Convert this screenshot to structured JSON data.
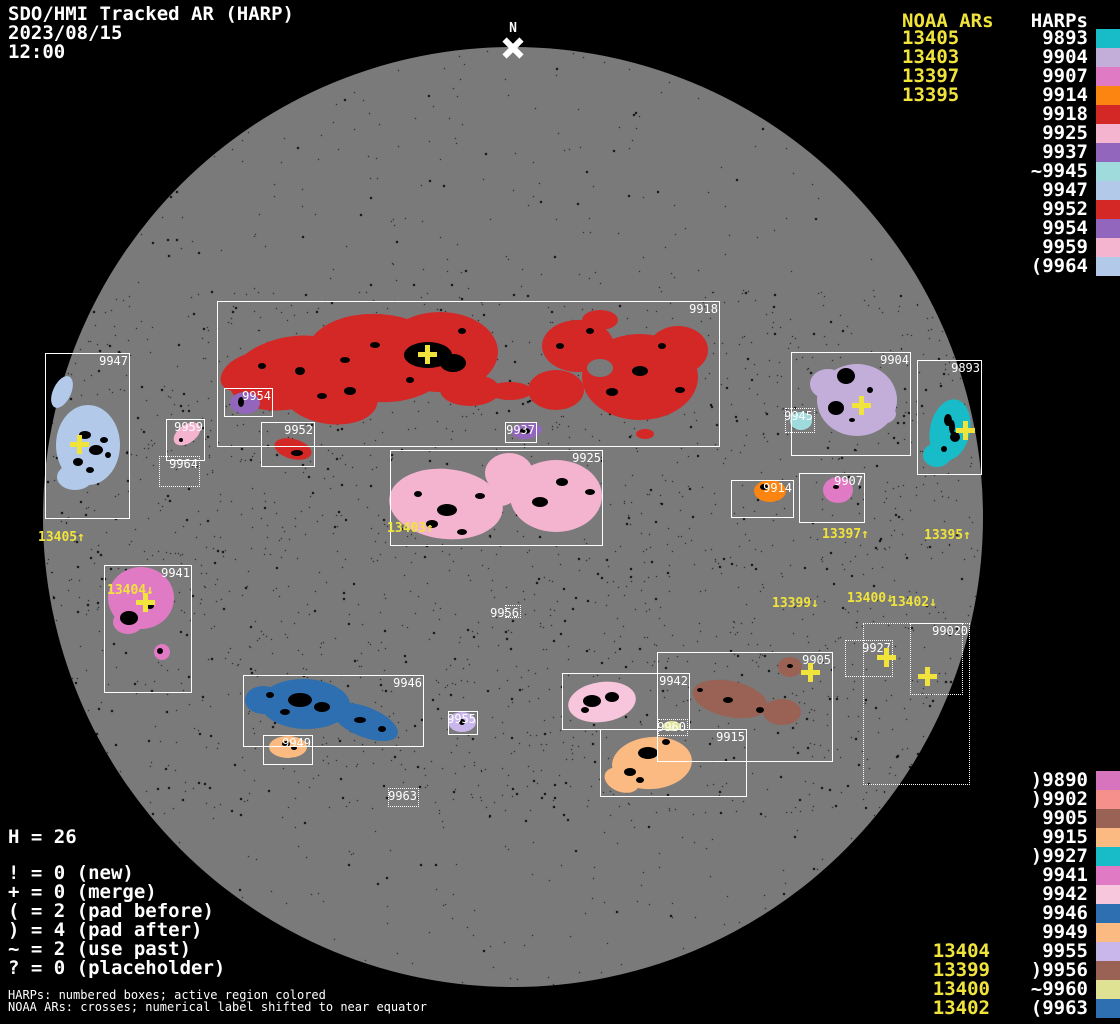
{
  "header": {
    "title": "SDO/HMI Tracked AR (HARP)",
    "date": "2023/08/15",
    "time": "12:00"
  },
  "north_marker": "N",
  "colors": {
    "background": "#000000",
    "disk": "#7a7a7a",
    "box_outline": "#ffffff",
    "noaa_yellow": "#f0e43c",
    "sunspot": "#000000"
  },
  "legend_top": {
    "noaa_header": "NOAA ARs",
    "harps_header": "HARPs",
    "rows": [
      {
        "noaa": "13405",
        "harp": "9893",
        "color": "#18bcc8"
      },
      {
        "noaa": "13403",
        "harp": "9904",
        "color": "#c2aed8"
      },
      {
        "noaa": "13397",
        "harp": "9907",
        "color": "#e07ac4"
      },
      {
        "noaa": "13395",
        "harp": "9914",
        "color": "#fb8510"
      },
      {
        "harp": "9918",
        "color": "#d42827"
      },
      {
        "harp": "9925",
        "color": "#f4b3cf"
      },
      {
        "harp": "9937",
        "color": "#9266bd"
      },
      {
        "harp": "~9945",
        "color": "#9fdbdd"
      },
      {
        "harp": "9947",
        "color": "#b3c9ea"
      },
      {
        "harp": "9952",
        "color": "#d42827"
      },
      {
        "harp": "9954",
        "color": "#9266bd"
      },
      {
        "harp": "9959",
        "color": "#f4b3cf"
      },
      {
        "harp": "(9964",
        "color": "#b3c9ea"
      }
    ]
  },
  "legend_bottom": {
    "rows": [
      {
        "harp": ")9890",
        "color": "#d873bd"
      },
      {
        "harp": ")9902",
        "color": "#f5908d"
      },
      {
        "harp": "9905",
        "color": "#996255"
      },
      {
        "harp": "9915",
        "color": "#fbba81"
      },
      {
        "harp": ")9927",
        "color": "#18bcc8"
      },
      {
        "harp": "9941",
        "color": "#e07ac4"
      },
      {
        "harp": "9942",
        "color": "#f7c5dc"
      },
      {
        "harp": "9946",
        "color": "#2d6fb0"
      },
      {
        "harp": "9949",
        "color": "#fbba81"
      },
      {
        "noaa": "13404",
        "harp": "9955",
        "color": "#c9b6ea"
      },
      {
        "noaa": "13399",
        "harp": ")9956",
        "color": "#996255"
      },
      {
        "noaa": "13400",
        "harp": "~9960",
        "color": "#dfe293"
      },
      {
        "noaa": "13402",
        "harp": "(9963",
        "color": "#2d6fb0"
      }
    ]
  },
  "stats": {
    "total": "H = 26",
    "lines": [
      "! = 0 (new)",
      "+ = 0 (merge)",
      "( = 2 (pad before)",
      ") = 4 (pad after)",
      "~ = 2 (use past)",
      "? = 0 (placeholder)"
    ]
  },
  "footer": {
    "line1": "HARPs: numbered boxes; active region colored",
    "line2": "NOAA ARs: crosses; numerical label shifted to near equator"
  },
  "regions": [
    {
      "id": "9918",
      "label": "9918",
      "box": [
        217,
        301,
        503,
        146
      ],
      "style": "solid",
      "color": "#d42827",
      "blobs": [
        [
          290,
          373,
          62,
          36,
          -12
        ],
        [
          378,
          358,
          72,
          44,
          4
        ],
        [
          440,
          352,
          58,
          40,
          0
        ],
        [
          330,
          396,
          48,
          28,
          8
        ],
        [
          247,
          372,
          28,
          17,
          -25
        ],
        [
          470,
          390,
          30,
          16,
          0
        ],
        [
          510,
          391,
          22,
          9,
          0
        ],
        [
          578,
          346,
          36,
          26,
          0
        ],
        [
          640,
          377,
          58,
          43,
          0
        ],
        [
          678,
          350,
          30,
          24,
          0
        ],
        [
          556,
          390,
          28,
          20,
          0
        ],
        [
          600,
          320,
          18,
          10,
          0
        ],
        [
          645,
          434,
          9,
          5,
          0
        ]
      ],
      "holes": [
        [
          600,
          368,
          13,
          9
        ]
      ],
      "spots": [
        [
          428,
          355,
          24,
          13
        ],
        [
          453,
          363,
          13,
          9
        ],
        [
          350,
          391,
          6,
          4
        ],
        [
          300,
          371,
          5,
          4
        ],
        [
          322,
          396,
          5,
          3
        ],
        [
          560,
          346,
          4,
          3
        ],
        [
          612,
          392,
          6,
          4
        ],
        [
          640,
          371,
          8,
          5
        ],
        [
          662,
          346,
          4,
          3
        ],
        [
          590,
          331,
          4,
          3
        ],
        [
          462,
          331,
          4,
          3
        ],
        [
          262,
          366,
          4,
          3
        ],
        [
          375,
          345,
          5,
          3
        ],
        [
          410,
          380,
          4,
          3
        ],
        [
          680,
          390,
          5,
          3
        ],
        [
          345,
          360,
          5,
          3
        ]
      ]
    },
    {
      "id": "9947",
      "label": "9947",
      "box": [
        45,
        353,
        85,
        166
      ],
      "style": "solid",
      "color": "#b3c9ea",
      "blobs": [
        [
          88,
          445,
          32,
          40,
          0
        ],
        [
          75,
          477,
          18,
          13,
          0
        ],
        [
          62,
          392,
          9,
          17,
          25
        ]
      ],
      "spots": [
        [
          85,
          435,
          6,
          4
        ],
        [
          96,
          450,
          7,
          5
        ],
        [
          78,
          462,
          5,
          4
        ],
        [
          104,
          440,
          4,
          3
        ],
        [
          90,
          470,
          4,
          3
        ],
        [
          108,
          455,
          3,
          3
        ]
      ]
    },
    {
      "id": "9959",
      "label": "9959",
      "box": [
        166,
        419,
        39,
        42
      ],
      "style": "solid",
      "color": "#f4b3cf",
      "blobs": [
        [
          187,
          434,
          15,
          9,
          -35
        ]
      ],
      "spots": [
        [
          181,
          440,
          2,
          2
        ]
      ]
    },
    {
      "id": "9964",
      "label": "9964",
      "box": [
        159,
        456,
        41,
        31
      ],
      "style": "dotted",
      "blobs": [],
      "spots": []
    },
    {
      "id": "9954",
      "label": "9954",
      "box": [
        224,
        388,
        49,
        29
      ],
      "style": "solid",
      "color": "#9266bd",
      "blobs": [
        [
          245,
          403,
          15,
          11,
          0
        ]
      ],
      "spots": [
        [
          241,
          402,
          3,
          5
        ]
      ]
    },
    {
      "id": "9952",
      "label": "9952",
      "box": [
        261,
        422,
        54,
        45
      ],
      "style": "solid",
      "color": "#d42827",
      "blobs": [
        [
          293,
          449,
          19,
          10,
          15
        ]
      ],
      "spots": [
        [
          297,
          453,
          6,
          3
        ]
      ]
    },
    {
      "id": "9937",
      "label": "9937",
      "box": [
        505,
        422,
        32,
        21
      ],
      "style": "solid",
      "color": "#9266bd",
      "blobs": [
        [
          527,
          431,
          15,
          8,
          -8
        ]
      ],
      "spots": [
        [
          525,
          431,
          5,
          3
        ]
      ]
    },
    {
      "id": "9925",
      "label": "9925",
      "box": [
        390,
        450,
        213,
        96
      ],
      "style": "solid",
      "color": "#f4b3cf",
      "blobs": [
        [
          446,
          504,
          57,
          35,
          6
        ],
        [
          509,
          473,
          24,
          20,
          0
        ],
        [
          500,
          497,
          14,
          9,
          0
        ],
        [
          556,
          496,
          46,
          36,
          0
        ]
      ],
      "spots": [
        [
          447,
          510,
          10,
          6
        ],
        [
          432,
          524,
          6,
          4
        ],
        [
          480,
          496,
          5,
          3
        ],
        [
          540,
          502,
          8,
          5
        ],
        [
          562,
          482,
          6,
          4
        ],
        [
          590,
          492,
          5,
          3
        ],
        [
          418,
          494,
          4,
          3
        ],
        [
          462,
          532,
          5,
          3
        ]
      ]
    },
    {
      "id": "9941",
      "label": "9941",
      "box": [
        104,
        565,
        88,
        128
      ],
      "style": "solid",
      "color": "#e07ac4",
      "blobs": [
        [
          141,
          598,
          33,
          31,
          0
        ],
        [
          128,
          622,
          15,
          12,
          0
        ],
        [
          162,
          652,
          8,
          8,
          0
        ]
      ],
      "spots": [
        [
          129,
          618,
          9,
          7
        ],
        [
          150,
          606,
          4,
          3
        ],
        [
          160,
          651,
          3,
          3
        ]
      ]
    },
    {
      "id": "9904",
      "label": "9904",
      "box": [
        791,
        352,
        120,
        104
      ],
      "style": "solid",
      "color": "#c2aed8",
      "blobs": [
        [
          857,
          400,
          40,
          36,
          0
        ],
        [
          828,
          384,
          18,
          15,
          0
        ],
        [
          881,
          414,
          15,
          10,
          0
        ]
      ],
      "spots": [
        [
          846,
          376,
          9,
          8
        ],
        [
          836,
          408,
          8,
          7
        ],
        [
          870,
          390,
          3,
          3
        ],
        [
          852,
          420,
          3,
          2
        ]
      ]
    },
    {
      "id": "9893",
      "label": "9893",
      "box": [
        917,
        360,
        65,
        115
      ],
      "style": "solid",
      "color": "#18bcc8",
      "blobs": [
        [
          950,
          430,
          20,
          31,
          12
        ],
        [
          937,
          455,
          14,
          12,
          0
        ]
      ],
      "spots": [
        [
          948,
          420,
          4,
          6
        ],
        [
          955,
          437,
          5,
          5
        ],
        [
          944,
          449,
          3,
          3
        ],
        [
          952,
          427,
          3,
          7
        ]
      ]
    },
    {
      "id": "9945",
      "label": "9945",
      "box": [
        785,
        408,
        30,
        25
      ],
      "style": "dotted",
      "color": "#9fdbdd",
      "blobs": [
        [
          801,
          421,
          11,
          9,
          0
        ]
      ],
      "spots": []
    },
    {
      "id": "9907",
      "label": "9907",
      "box": [
        799,
        473,
        66,
        50
      ],
      "style": "solid",
      "color": "#e07ac4",
      "blobs": [
        [
          838,
          490,
          15,
          13,
          0
        ]
      ],
      "spots": [
        [
          836,
          487,
          3,
          2
        ]
      ]
    },
    {
      "id": "9914",
      "label": "9914",
      "box": [
        731,
        480,
        63,
        38
      ],
      "style": "solid",
      "color": "#fb8510",
      "blobs": [
        [
          770,
          491,
          16,
          11,
          0
        ]
      ],
      "spots": [
        [
          764,
          487,
          4,
          3
        ]
      ]
    },
    {
      "id": "9956",
      "label": "9956",
      "box": [
        505,
        605,
        16,
        13
      ],
      "style": "dotted",
      "blobs": [],
      "spots": []
    },
    {
      "id": "9946",
      "label": "9946",
      "box": [
        243,
        675,
        181,
        72
      ],
      "style": "solid",
      "color": "#2d6fb0",
      "blobs": [
        [
          305,
          704,
          45,
          25,
          2
        ],
        [
          365,
          722,
          35,
          15,
          22
        ],
        [
          263,
          700,
          18,
          14,
          0
        ]
      ],
      "spots": [
        [
          300,
          700,
          12,
          7
        ],
        [
          322,
          707,
          8,
          5
        ],
        [
          285,
          712,
          5,
          3
        ],
        [
          360,
          720,
          6,
          3
        ],
        [
          382,
          729,
          4,
          3
        ],
        [
          270,
          695,
          4,
          3
        ]
      ]
    },
    {
      "id": "9949",
      "label": "9949",
      "box": [
        263,
        735,
        50,
        30
      ],
      "style": "solid",
      "color": "#fbba81",
      "blobs": [
        [
          288,
          747,
          19,
          11,
          0
        ]
      ],
      "spots": [
        [
          286,
          744,
          4,
          3
        ],
        [
          294,
          748,
          3,
          2
        ]
      ]
    },
    {
      "id": "9955",
      "label": "9955",
      "box": [
        448,
        711,
        30,
        24
      ],
      "style": "solid",
      "color": "#c9b6ea",
      "blobs": [
        [
          462,
          722,
          14,
          10,
          0
        ]
      ],
      "spots": [
        [
          462,
          722,
          3,
          3
        ]
      ]
    },
    {
      "id": "9963",
      "label": "9963",
      "box": [
        388,
        788,
        31,
        19
      ],
      "style": "dotted",
      "blobs": [],
      "spots": []
    },
    {
      "id": "9942",
      "label": "9942",
      "box": [
        562,
        673,
        128,
        57
      ],
      "style": "solid",
      "color": "#f7c5dc",
      "blobs": [
        [
          602,
          702,
          34,
          20,
          -8
        ]
      ],
      "spots": [
        [
          592,
          701,
          9,
          6
        ],
        [
          612,
          697,
          7,
          5
        ],
        [
          585,
          710,
          4,
          3
        ]
      ]
    },
    {
      "id": "9960",
      "label": "9960",
      "box": [
        658,
        719,
        30,
        17
      ],
      "style": "dotted",
      "color": "#dfe293",
      "blobs": [
        [
          672,
          726,
          9,
          5,
          0
        ]
      ],
      "spots": []
    },
    {
      "id": "9905",
      "label": "9905",
      "box": [
        657,
        652,
        176,
        110
      ],
      "style": "solid",
      "color": "#996255",
      "blobs": [
        [
          730,
          699,
          38,
          18,
          12
        ],
        [
          782,
          712,
          19,
          13,
          0
        ],
        [
          790,
          667,
          12,
          10,
          0
        ]
      ],
      "spots": [
        [
          728,
          700,
          5,
          3
        ],
        [
          760,
          710,
          4,
          3
        ],
        [
          700,
          690,
          3,
          2
        ],
        [
          790,
          666,
          3,
          2
        ]
      ]
    },
    {
      "id": "9915",
      "label": "9915",
      "box": [
        600,
        729,
        147,
        68
      ],
      "style": "solid",
      "color": "#fbba81",
      "blobs": [
        [
          652,
          763,
          40,
          26,
          -5
        ],
        [
          622,
          780,
          18,
          12,
          20
        ]
      ],
      "spots": [
        [
          648,
          753,
          10,
          6
        ],
        [
          630,
          772,
          6,
          4
        ],
        [
          666,
          742,
          4,
          3
        ],
        [
          640,
          780,
          4,
          3
        ]
      ]
    },
    {
      "id": "9927",
      "label": "9927",
      "box": [
        845,
        640,
        48,
        37
      ],
      "style": "dotted",
      "blobs": [],
      "spots": []
    },
    {
      "id": "9890",
      "label": "0",
      "box": [
        863,
        623,
        107,
        162
      ],
      "style": "dotted",
      "blobs": [],
      "spots": []
    },
    {
      "id": "9902",
      "label": "9902",
      "box": [
        910,
        623,
        53,
        72
      ],
      "style": "dotted",
      "blobs": [],
      "spots": []
    }
  ],
  "crosses": [
    {
      "x": 428,
      "y": 355
    },
    {
      "x": 80,
      "y": 445
    },
    {
      "x": 146,
      "y": 603
    },
    {
      "x": 862,
      "y": 406
    },
    {
      "x": 966,
      "y": 431
    },
    {
      "x": 811,
      "y": 673
    },
    {
      "x": 887,
      "y": 658
    },
    {
      "x": 928,
      "y": 677
    }
  ],
  "noaa_shifted_labels": [
    {
      "text": "13405↑",
      "x": 38,
      "y": 531
    },
    {
      "text": "13403↑",
      "x": 387,
      "y": 522
    },
    {
      "text": "13404↓",
      "x": 107,
      "y": 584
    },
    {
      "text": "13397↑",
      "x": 822,
      "y": 528
    },
    {
      "text": "13395↑",
      "x": 924,
      "y": 529
    },
    {
      "text": "13399↓",
      "x": 772,
      "y": 597
    },
    {
      "text": "13400↓",
      "x": 847,
      "y": 592
    },
    {
      "text": "13402↓",
      "x": 890,
      "y": 596
    }
  ]
}
